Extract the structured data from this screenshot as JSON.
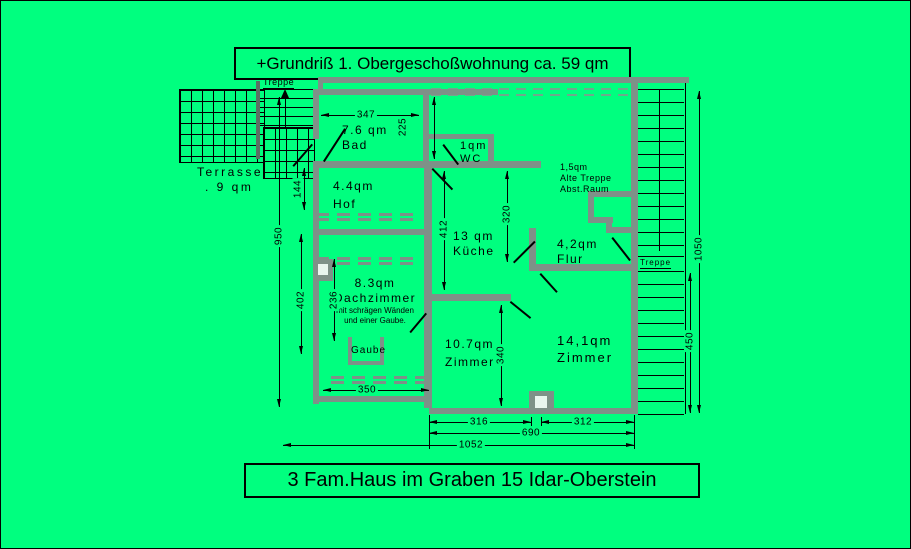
{
  "colors": {
    "background": "#00ff7f",
    "wall": "#7e9188",
    "line": "#000000",
    "text": "#000000"
  },
  "header": {
    "title": "+Grundriß 1. Obergeschoßwohnung ca. 59 qm"
  },
  "footer": {
    "title": "3 Fam.Haus  im Graben 15 Idar-Oberstein"
  },
  "rooms": {
    "bad": {
      "area": "7.6 qm",
      "name": "Bad"
    },
    "wc": {
      "area": "1qm",
      "name": "WC"
    },
    "hof": {
      "area": "4.4qm",
      "name": "Hof"
    },
    "kueche": {
      "area": "13 qm",
      "name": "Küche"
    },
    "flur": {
      "area": "4,2qm",
      "name": "Flur"
    },
    "alte_treppe": {
      "area": "1,5qm",
      "name": "Alte Treppe",
      "name2": "Abst.Raum"
    },
    "dachzimmer": {
      "area": "8.3qm",
      "name": "Dachzimmer",
      "note1": "mit schrägen Wänden",
      "note2": "und einer Gaube."
    },
    "zimmer_klein": {
      "area": "10.7qm",
      "name": "Zimmer"
    },
    "zimmer_gross": {
      "area": "14,1qm",
      "name": "Zimmer"
    },
    "terrasse": {
      "name": "Terrasse",
      "area": ". 9 qm"
    },
    "gaube": {
      "name": "Gaube"
    },
    "treppe_links": {
      "name": "Treppe"
    },
    "treppe_rechts": {
      "name": "Treppe"
    }
  },
  "dimensions": {
    "bad_breite": "347",
    "bad_tiefe": "225",
    "hof_abstand": "144",
    "links_hoehe": "950",
    "dach_hoehe": "402",
    "dach_innen": "236",
    "kueche_hoehe": "412",
    "flur_hoehe": "320",
    "zimmer_klein_hoehe": "340",
    "dach_breite": "350",
    "zimmer_klein_breite": "316",
    "zimmer_gross_breite": "312",
    "mitte_breite": "690",
    "gesamt_breite": "1052",
    "treppe_unten": "450",
    "rechts_hoehe": "1050"
  }
}
